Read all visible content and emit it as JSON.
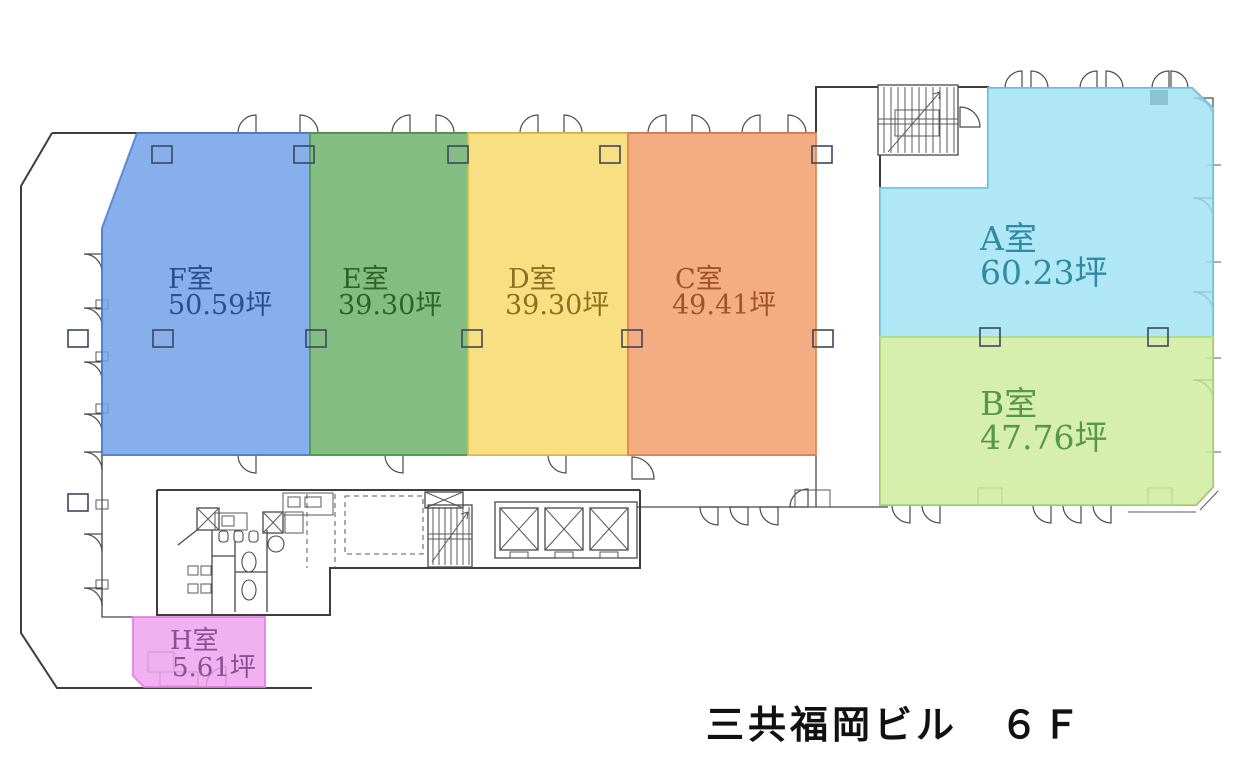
{
  "title": "三共福岡ビル　６Ｆ",
  "building_name": "三共福岡ビル",
  "floor": "６Ｆ",
  "area_unit": "坪",
  "rooms": [
    {
      "id": "A",
      "name": "A室",
      "area": "60.23坪",
      "fill": "#9fe2f3",
      "text": "#2f8ba4"
    },
    {
      "id": "B",
      "name": "B室",
      "area": "47.76坪",
      "fill": "#cdec9b",
      "text": "#55984b"
    },
    {
      "id": "C",
      "name": "C室",
      "area": "49.41坪",
      "fill": "#f29a66",
      "text": "#a3512a"
    },
    {
      "id": "D",
      "name": "D室",
      "area": "39.30坪",
      "fill": "#f6d865",
      "text": "#8f6e22"
    },
    {
      "id": "E",
      "name": "E室",
      "area": "39.30坪",
      "fill": "#69ae67",
      "text": "#2c6329"
    },
    {
      "id": "F",
      "name": "F室",
      "area": "50.59坪",
      "fill": "#6d9de6",
      "text": "#2c4d8f"
    },
    {
      "id": "H",
      "name": "H室",
      "area": "5.61坪",
      "fill": "#eea0ed",
      "text": "#8f4d92"
    }
  ]
}
